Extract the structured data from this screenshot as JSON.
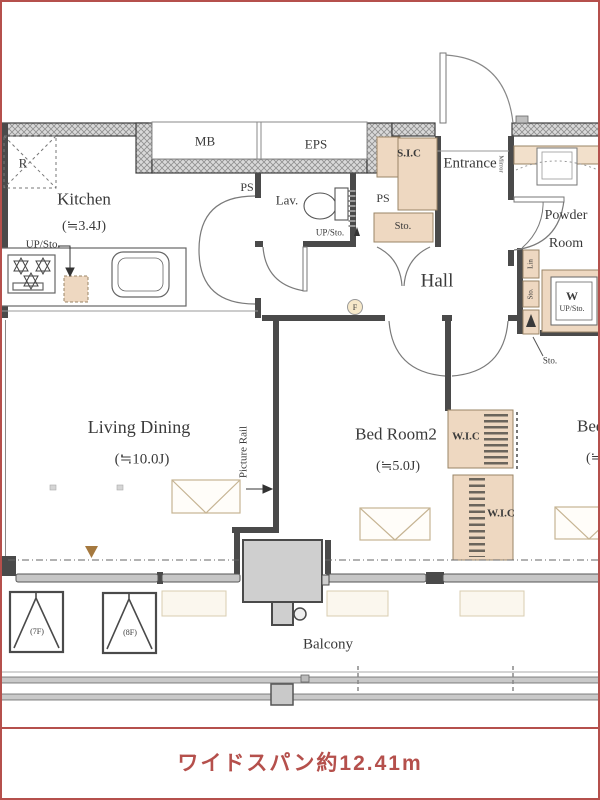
{
  "plan": {
    "rooms": {
      "kitchen": {
        "name": "Kitchen",
        "size": "(≒3.4J)"
      },
      "living_dining": {
        "name": "Living Dining",
        "size": "(≒10.0J)"
      },
      "bed_room2": {
        "name": "Bed Room2",
        "size": "(≒5.0J)"
      },
      "bed_room": {
        "name": "Bed Room",
        "size": "(≒"
      },
      "hall": {
        "name": "Hall"
      },
      "entrance": {
        "name": "Entrance"
      },
      "lav": {
        "name": "Lav."
      },
      "powder_room": {
        "name_line1": "Powder",
        "name_line2": "Room"
      },
      "balcony": {
        "name": "Balcony"
      }
    },
    "labels": {
      "mb": "MB",
      "eps": "EPS",
      "ps_a": "PS",
      "ps_b": "PS",
      "r": "R",
      "sic": "S.I.C",
      "sto_hall": "Sto.",
      "sto_pointer": "Sto.",
      "up_sto_kitchen": "UP/Sto.",
      "up_sto_lav": "UP/Sto.",
      "lin": "Lin",
      "sto_linen": "Sto.",
      "w": "W",
      "w_up_sto": "UP/Sto.",
      "wic_upper": "W.I.C",
      "wic_lower": "W.I.C",
      "mirror": "Mirror",
      "picture_rail": "Picture Rail",
      "f_mark": "F",
      "hatch_7f": "(7F)",
      "hatch_8f": "(8F)"
    },
    "dimension_note": "ワイドスパン約12.41m",
    "colors": {
      "accent_red": "#b5504c",
      "wall": "#4a4a4a",
      "closet_beige": "#eed8c1"
    }
  }
}
